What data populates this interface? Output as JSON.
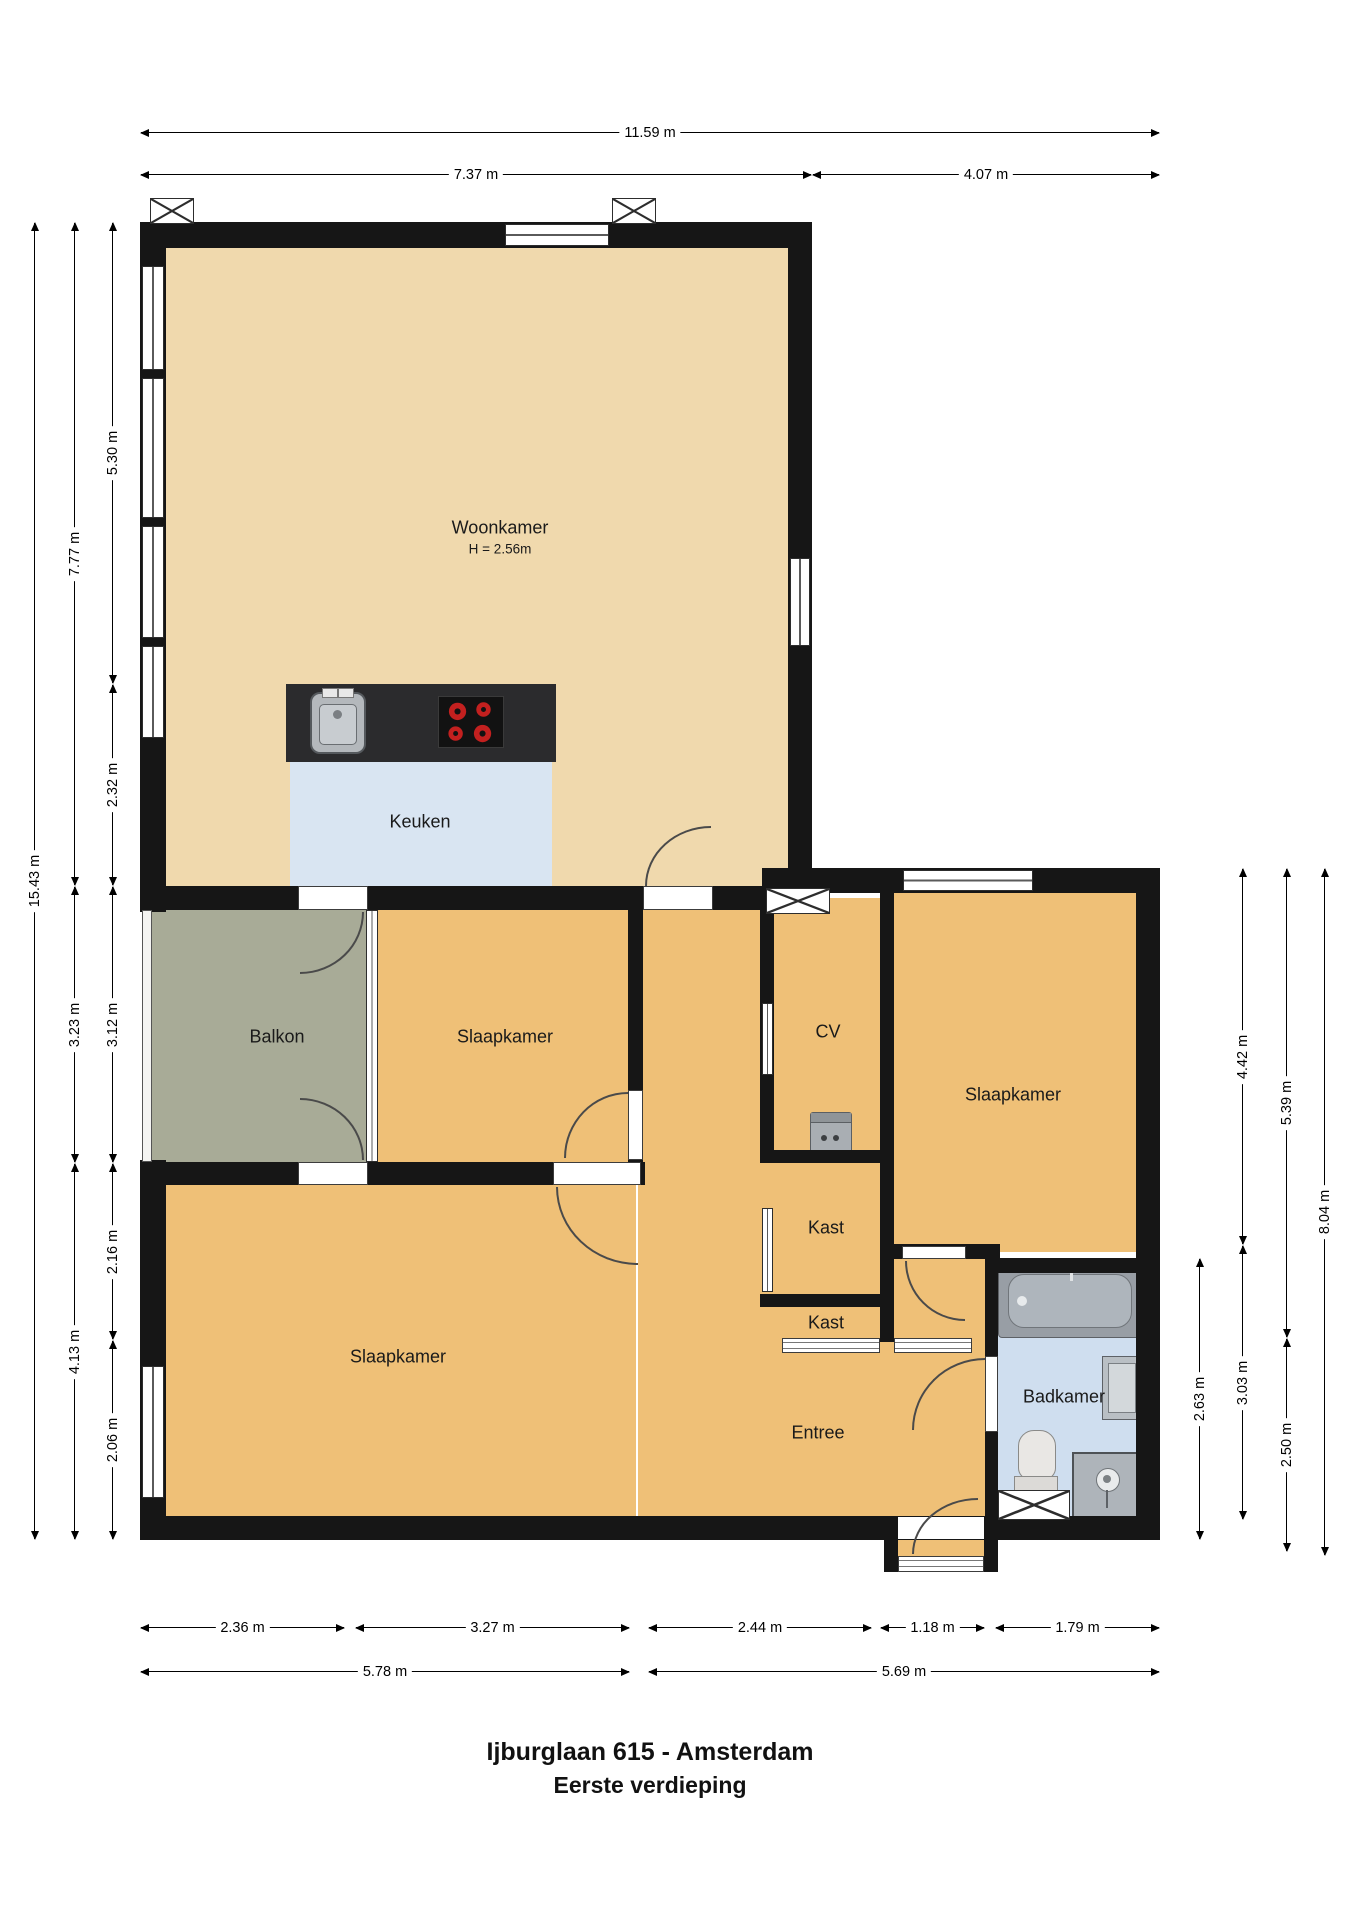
{
  "title": {
    "line1": "Ijburglaan 615 - Amsterdam",
    "line2": "Eerste verdieping"
  },
  "rooms": {
    "woonkamer": {
      "label": "Woonkamer",
      "height_note": "H = 2.56m"
    },
    "keuken": {
      "label": "Keuken"
    },
    "balkon": {
      "label": "Balkon"
    },
    "slaapkamer_mid": {
      "label": "Slaapkamer"
    },
    "slaapkamer_right": {
      "label": "Slaapkamer"
    },
    "slaapkamer_bottom": {
      "label": "Slaapkamer"
    },
    "cv": {
      "label": "CV"
    },
    "kast_upper": {
      "label": "Kast"
    },
    "kast_lower": {
      "label": "Kast"
    },
    "entree": {
      "label": "Entree"
    },
    "badkamer": {
      "label": "Badkamer"
    }
  },
  "dims": {
    "top_total": "11.59 m",
    "top_left": "7.37 m",
    "top_right": "4.07 m",
    "left_total": "15.43 m",
    "left_mid_1": "7.77 m",
    "left_mid_2": "3.23 m",
    "left_mid_3": "4.13 m",
    "left_in_1": "5.30 m",
    "left_in_2": "2.32 m",
    "left_in_3": "3.12 m",
    "left_in_4": "2.16 m",
    "left_in_5": "2.06 m",
    "right_bath": "2.63 m",
    "right_in_1": "4.42 m",
    "right_in_2": "3.03 m",
    "right_mid_1": "5.39 m",
    "right_mid_2": "2.50 m",
    "right_total": "8.04 m",
    "bottom_1": "2.36 m",
    "bottom_2": "3.27 m",
    "bottom_3": "2.44 m",
    "bottom_4": "1.18 m",
    "bottom_5": "1.79 m",
    "bottom_left_total": "5.78 m",
    "bottom_right_total": "5.69 m"
  },
  "fixtures": {
    "kitchen_sink": "sink-icon",
    "stove": "stove-icon",
    "cv_boiler": "boiler-icon",
    "bathtub": "bathtub-icon",
    "washbasin": "washbasin-icon",
    "toilet": "toilet-icon",
    "shower": "shower-icon",
    "vent": "vent-cross-icon"
  },
  "colors": {
    "wall": "#161616",
    "floor_living": "#f0d9ad",
    "floor_rooms": "#efc077",
    "floor_kitchen": "#d9e5f2",
    "floor_bath": "#cfdeef",
    "floor_balcony": "#a8ab97",
    "counter": "#2b2b2d",
    "burner_red": "#c3201f"
  }
}
